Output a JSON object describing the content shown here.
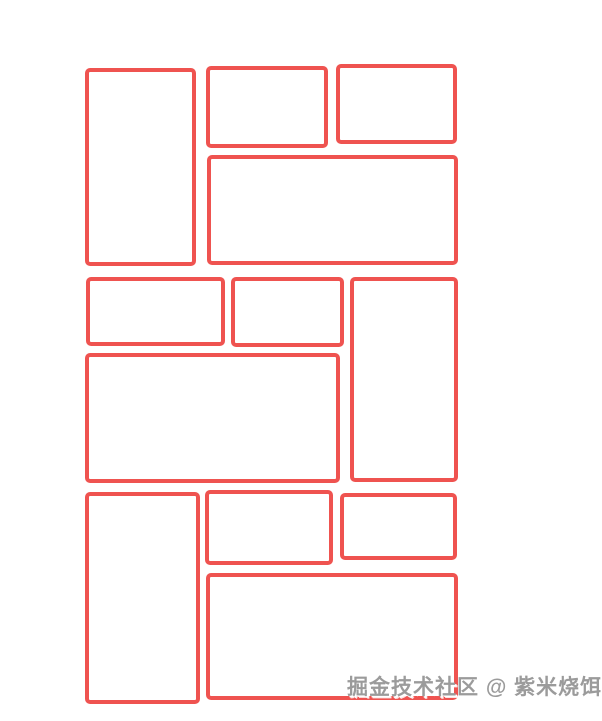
{
  "page": {
    "background_color": "#ffffff"
  },
  "layout_demo": {
    "description": "grid-of-red-outlined-boxes",
    "box_border_color": "#ef5350",
    "box_border_width_px": 4,
    "box_fill_color": "#ffffff",
    "groups": [
      {
        "name": "top-group",
        "boxes": [
          {
            "role": "tall-left-box",
            "x": 85,
            "y": 68,
            "w": 111,
            "h": 198
          },
          {
            "role": "small-box-1",
            "x": 206,
            "y": 66,
            "w": 122,
            "h": 82
          },
          {
            "role": "small-box-2",
            "x": 336,
            "y": 64,
            "w": 121,
            "h": 80
          },
          {
            "role": "wide-bottom-box",
            "x": 207,
            "y": 155,
            "w": 251,
            "h": 110
          }
        ]
      },
      {
        "name": "middle-group",
        "boxes": [
          {
            "role": "small-box-1",
            "x": 86,
            "y": 277,
            "w": 139,
            "h": 69
          },
          {
            "role": "small-box-2",
            "x": 231,
            "y": 277,
            "w": 113,
            "h": 70
          },
          {
            "role": "tall-right-box",
            "x": 350,
            "y": 277,
            "w": 108,
            "h": 205
          },
          {
            "role": "wide-bottom-box",
            "x": 85,
            "y": 353,
            "w": 255,
            "h": 130
          }
        ]
      },
      {
        "name": "bottom-group",
        "boxes": [
          {
            "role": "tall-left-box",
            "x": 85,
            "y": 492,
            "w": 115,
            "h": 212
          },
          {
            "role": "small-box-1",
            "x": 205,
            "y": 490,
            "w": 128,
            "h": 75
          },
          {
            "role": "small-box-2",
            "x": 340,
            "y": 493,
            "w": 117,
            "h": 67
          },
          {
            "role": "wide-bottom-box",
            "x": 206,
            "y": 573,
            "w": 252,
            "h": 127
          }
        ]
      }
    ]
  },
  "watermark": {
    "text": "掘金技术社区 @ 紫米烧饵块",
    "color": "#9b9b9b",
    "x": 347,
    "y": 671
  }
}
